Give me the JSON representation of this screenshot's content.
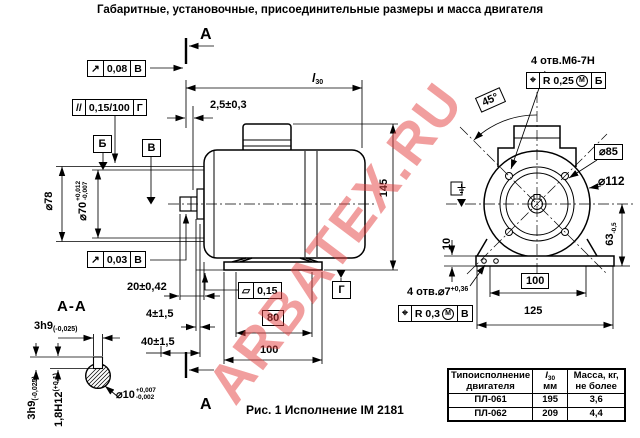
{
  "title": "Габаритные, установочные, присоединительные размеры и масса двигателя",
  "watermark": "ARBATEX.RU",
  "caption": "Рис. 1 Исполнение IМ 2181",
  "section_marks": {
    "top": "А",
    "bottom": "А",
    "title": "А-А"
  },
  "colors": {
    "watermark": "#e43e3e",
    "line": "#000000",
    "background": "#ffffff"
  },
  "datum_flags": {
    "b": "Б",
    "v": "В",
    "g": "Г"
  },
  "frames": {
    "runout_top": {
      "sym": "↗",
      "val": "0,08",
      "datum": "В"
    },
    "parallelism": {
      "sym": "//",
      "val": "0,15/100",
      "datum": "Г"
    },
    "runout_shaft": {
      "sym": "↗",
      "val": "0,03",
      "datum": "В"
    },
    "flatness": {
      "sym": "▱",
      "val": "0,15"
    },
    "position_flange": {
      "sym": "⌖",
      "val": "R 0,25",
      "mod": "М",
      "datum": "Б"
    },
    "position_feet": {
      "sym": "⌖",
      "val": "R 0,3",
      "mod": "М",
      "datum": "В"
    }
  },
  "side_view": {
    "l30": {
      "main": "l",
      "sub": "30"
    },
    "gap": "2,5±0,3",
    "shaft_ext": "20±0,42",
    "key_pos": "4±1,5",
    "key_len": "40±1,5",
    "holes_span": "80",
    "feet_span": "100",
    "height": "145",
    "shield_dia": "⌀78",
    "spigot": {
      "main": "⌀70",
      "sup": "+0,012",
      "sub": "-0,007"
    }
  },
  "front_view": {
    "tap_holes": "4 отв.М6-7Н",
    "angle": "45°",
    "bolt_circle_dia": "⌀85",
    "flange_dia": "⌀112",
    "axis_height": {
      "main": "63",
      "sub": "-0,5"
    },
    "base_thickness": "10",
    "hole_span": "100",
    "base_width": "125",
    "foot_holes": {
      "main": "4 отв.⌀7",
      "sup": "+0,36"
    }
  },
  "section_view": {
    "key_width_top": {
      "main": "3h9",
      "tol": "(-0,025)"
    },
    "key_width_left": {
      "main": "3h9",
      "tol": "(-0,025)"
    },
    "key_depth": {
      "main": "1,8H12",
      "tol": "(+0,1)"
    },
    "shaft_dia": {
      "main": "⌀10",
      "sup": "+0,007",
      "sub": "-0,002"
    }
  },
  "table": {
    "header": {
      "col1_line1": "Типоисполнение",
      "col1_line2": "двигателя",
      "col2_main": "l",
      "col2_sub": "30",
      "col2_line2": "мм",
      "col3_line1": "Масса, кг,",
      "col3_line2": "не более"
    },
    "rows": [
      {
        "model": "ПЛ-061",
        "l30": "195",
        "mass": "3,6"
      },
      {
        "model": "ПЛ-062",
        "l30": "209",
        "mass": "4,4"
      }
    ]
  }
}
